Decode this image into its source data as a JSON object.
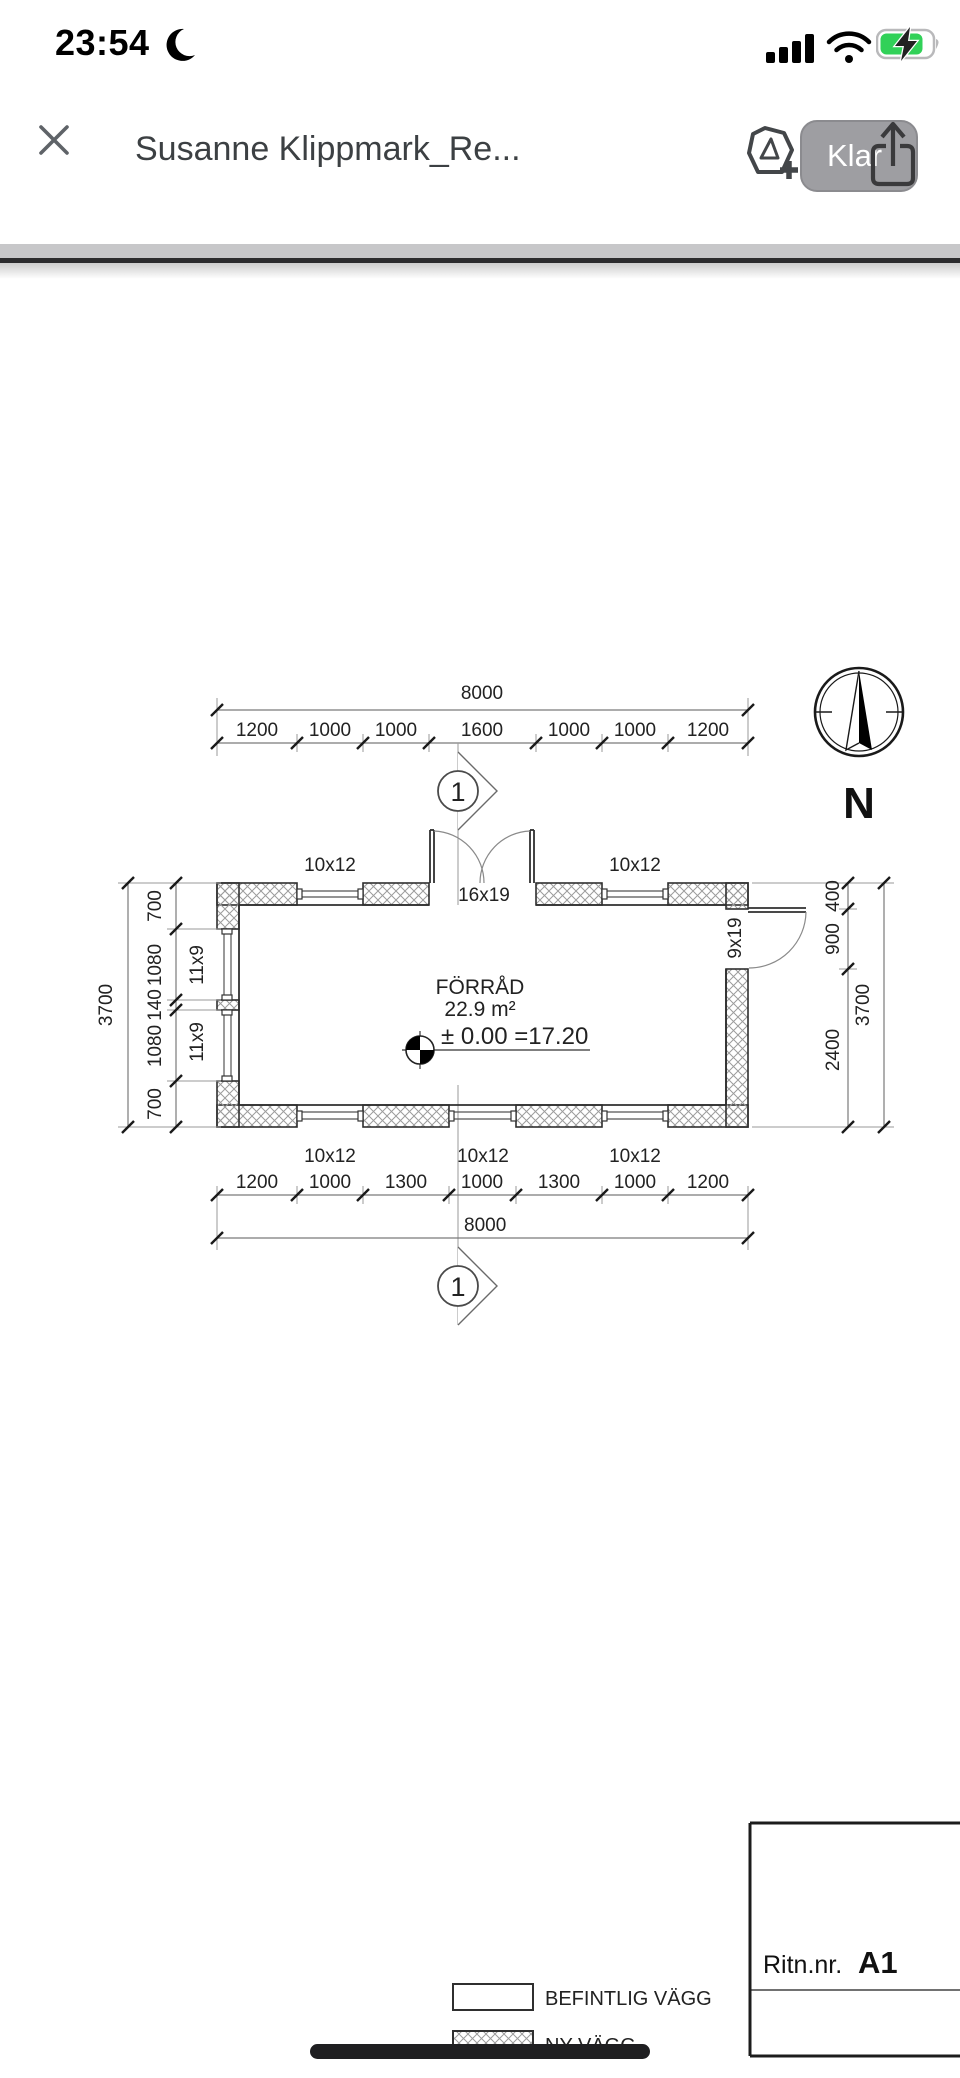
{
  "status_bar": {
    "time": "23:54"
  },
  "header": {
    "title": "Susanne Klippmark_Re...",
    "done_label": "Klar"
  },
  "drawing": {
    "north_label": "N",
    "section_marker": "1",
    "room": {
      "name": "FÖRRÅD",
      "area": "22.9 m²",
      "level": "± 0.00 =17.20"
    },
    "dims": {
      "top_total": "8000",
      "top_chain": [
        "1200",
        "1000",
        "1000",
        "1600",
        "1000",
        "1000",
        "1200"
      ],
      "bottom_chain": [
        "1200",
        "1000",
        "1300",
        "1000",
        "1300",
        "1000",
        "1200"
      ],
      "bottom_total": "8000",
      "left_total": "3700",
      "left_chain": [
        "700",
        "1080",
        "140",
        "1080",
        "700"
      ],
      "right_chain": [
        "400",
        "900",
        "2400"
      ],
      "right_total": "3700"
    },
    "openings": {
      "top_windows": [
        "10x12",
        "10x12"
      ],
      "top_door": "16x19",
      "right_door": "9x19",
      "left_windows": [
        "11x9",
        "11x9"
      ],
      "bottom_windows": [
        "10x12",
        "10x12",
        "10x12"
      ]
    },
    "title_block": {
      "label": "Ritn.nr.",
      "number": "A1"
    },
    "legend": [
      {
        "label": "BEFINTLIG VÄGG"
      },
      {
        "label": "NY VÄGG"
      }
    ]
  }
}
